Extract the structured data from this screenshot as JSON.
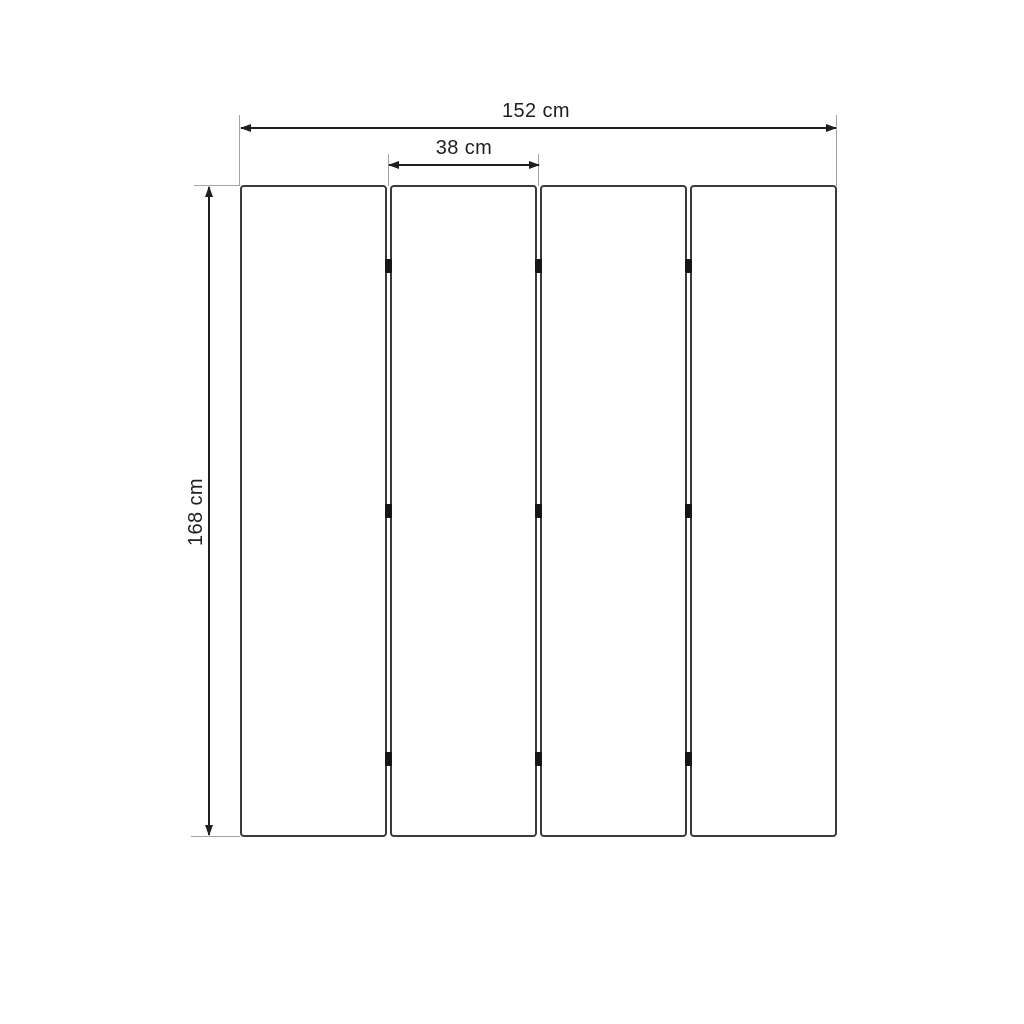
{
  "meta": {
    "type": "technical-dimension-diagram",
    "subject": "four-panel folding screen front view"
  },
  "labels": {
    "total_width": "152 cm",
    "panel_width": "38 cm",
    "height": "168 cm"
  },
  "structure": {
    "panel_count": 4,
    "gap_count": 3,
    "hinges_per_gap": 3
  },
  "colors": {
    "background": "#ffffff",
    "panel_fill": "#ffffff",
    "panel_border": "#3a3a3a",
    "dimension_line": "#1f1f1f",
    "extension_line": "#a3a3a3",
    "hinge": "#161616",
    "text": "#1f1f1f"
  }
}
